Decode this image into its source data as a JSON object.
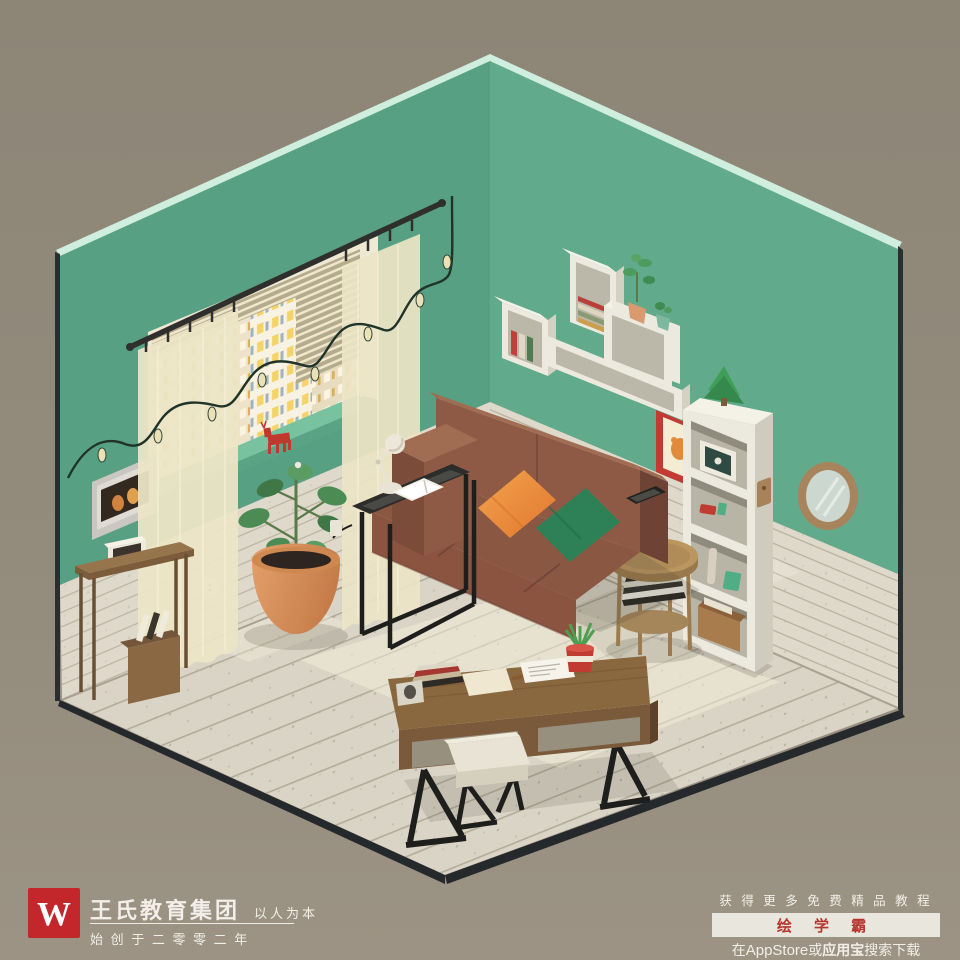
{
  "branding": {
    "logo_letter": "W",
    "company": "王氏教育集团",
    "slogan": "以人为本",
    "founded": "始 创 于 二 零 零 二 年"
  },
  "promo": {
    "line1": "获 得 更 多 免 费 精 品 教 程",
    "app_name": "绘 学 霸",
    "dl_prefix": "在",
    "dl_appstore": "AppStore",
    "dl_or": "或",
    "dl_store": "应用宝",
    "dl_suffix": "搜索下载"
  },
  "scene": {
    "description": "isometric living room render",
    "icons": [
      "string-lights-icon",
      "window-icon",
      "sofa-icon",
      "desk-icon",
      "bookshelf-icon",
      "mirror-icon",
      "plant-icon"
    ]
  },
  "palette": {
    "background": "#918978",
    "wall_left": "#58a083",
    "wall_right": "#61aa8b",
    "wall_edge": "#cfeede",
    "wainscot": "#ded9ca",
    "floor": "#d9d4c5",
    "sill": "#78c2a0",
    "sofa": "#8a5743",
    "sofa_dark": "#6e4234",
    "sofa_light": "#a06c52",
    "pillow_orange": "#ee9a42",
    "pillow_green": "#2e8156",
    "curtain": "#ece4c6",
    "desk_wood": "#8a683f",
    "drawer_gray": "#97907f",
    "terracotta": "#d8935e",
    "plant_green": "#4d8b55",
    "shelf_white": "#eceadf",
    "frame_red": "#c23a32",
    "mirror_wood": "#a8845c",
    "logo_red": "#c4272b",
    "promo_red": "#b5342c",
    "promo_bar_bg": "#e9e6dd"
  }
}
